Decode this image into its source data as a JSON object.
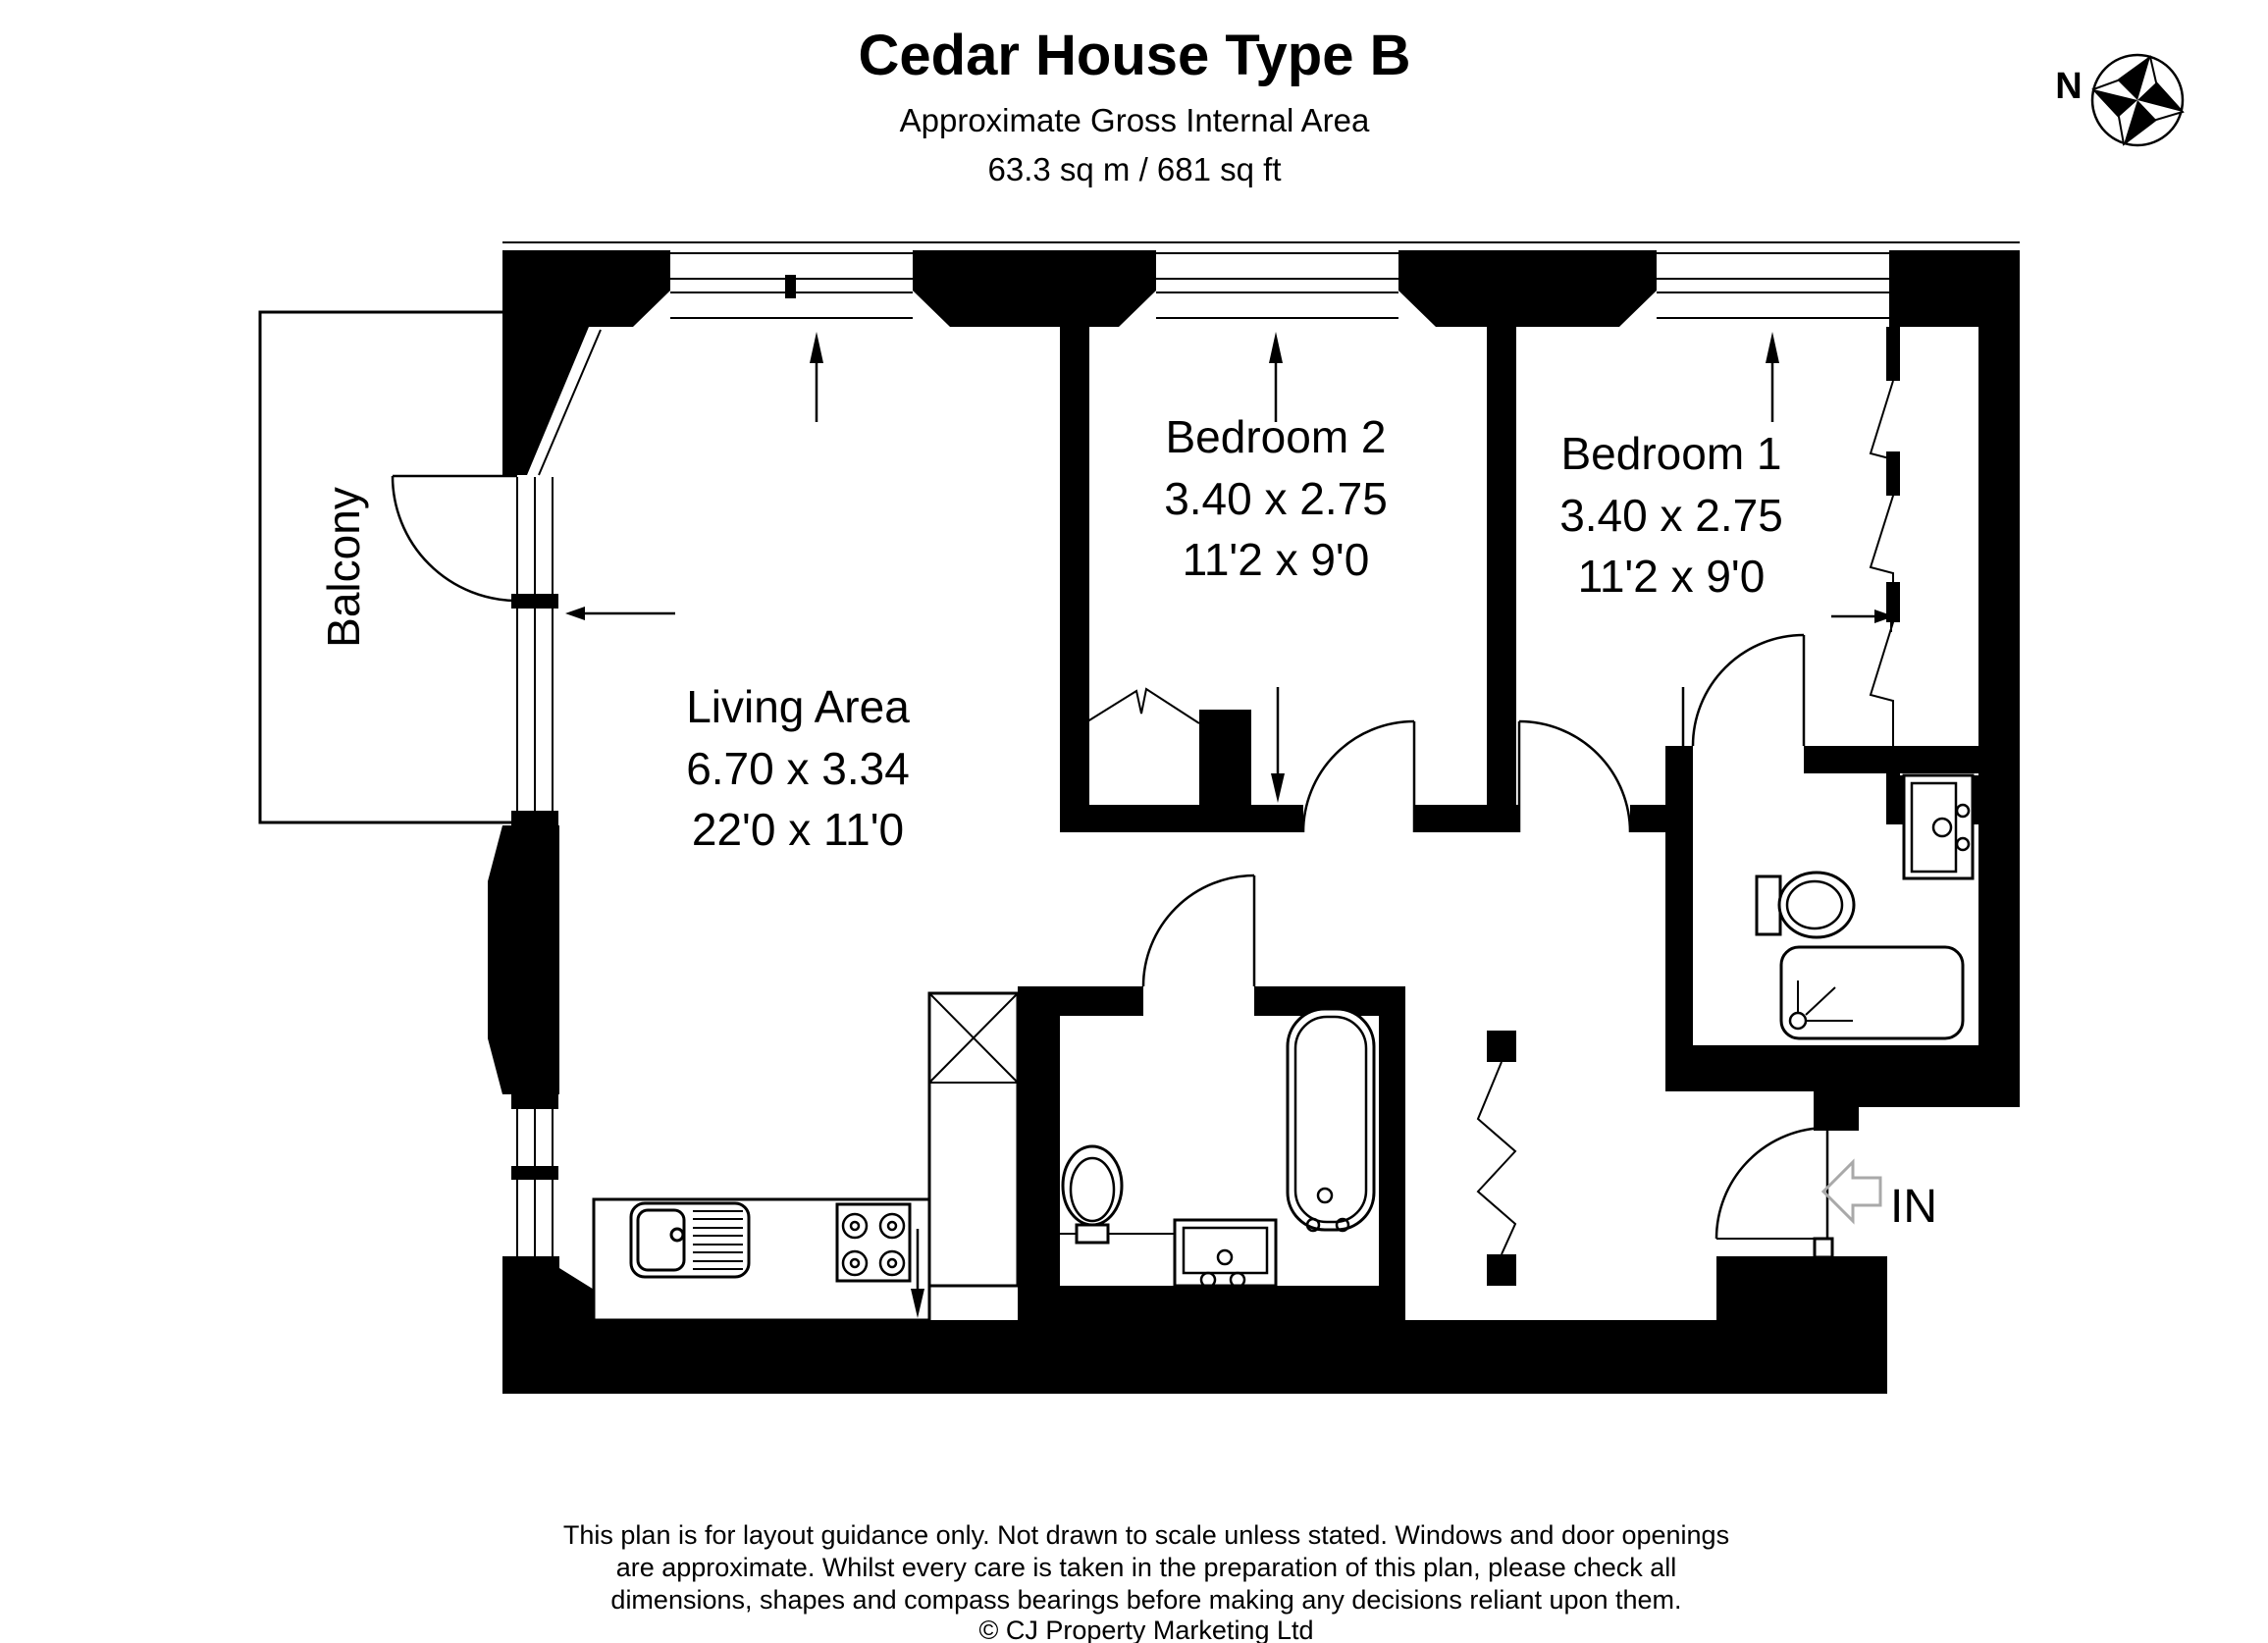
{
  "header": {
    "title": "Cedar House Type B",
    "subtitle": "Approximate Gross Internal Area",
    "area": "63.3 sq m / 681 sq ft"
  },
  "compass": {
    "north_label": "N"
  },
  "rooms": {
    "balcony": {
      "label": "Balcony"
    },
    "living_area": {
      "label": "Living Area",
      "metric": "6.70 x 3.34",
      "imperial": "22'0 x 11'0"
    },
    "bedroom_2": {
      "label": "Bedroom 2",
      "metric": "3.40 x 2.75",
      "imperial": "11'2 x 9'0"
    },
    "bedroom_1": {
      "label": "Bedroom 1",
      "metric": "3.40 x 2.75",
      "imperial": "11'2 x 9'0"
    }
  },
  "entrance": {
    "label": "IN"
  },
  "footer": {
    "line1": "This plan is for layout guidance only. Not drawn to scale unless stated. Windows and door openings",
    "line2": "are approximate. Whilst every care is taken in the preparation of this plan, please check all",
    "line3": "dimensions, shapes and compass bearings before making any decisions reliant upon them.",
    "copyright": "© CJ Property Marketing Ltd"
  },
  "colors": {
    "wall": "#000000",
    "background": "#ffffff",
    "entry_arrow": "#a9a9a9"
  }
}
